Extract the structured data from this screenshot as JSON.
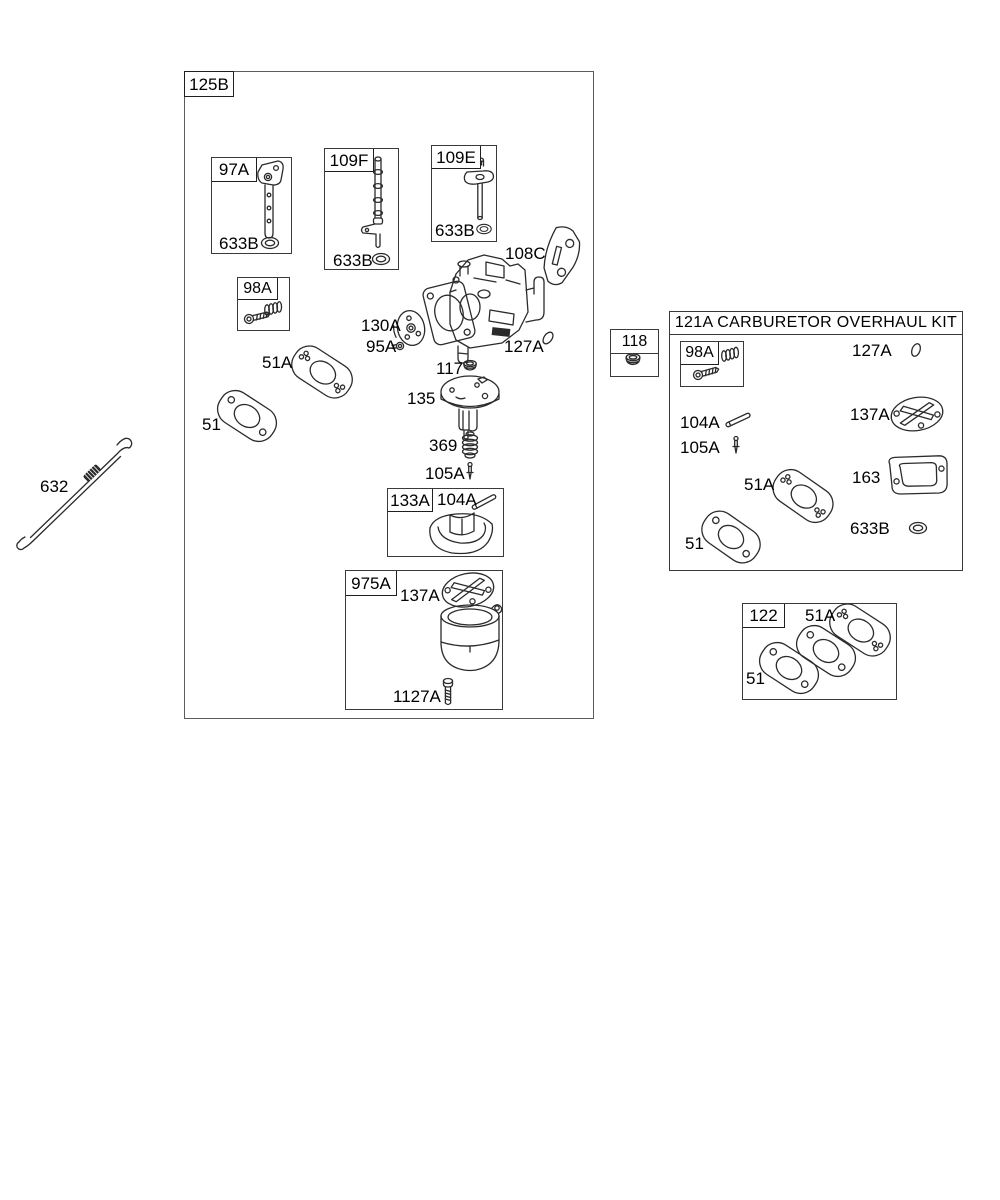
{
  "colors": {
    "line": "#2b2b2b",
    "background": "#ffffff",
    "box_border": "#5c5c5c"
  },
  "main_box": {
    "label": "125B"
  },
  "throttle_group": {
    "label": "97A",
    "seal": "633B"
  },
  "mixture_screw_group": {
    "label": "98A"
  },
  "needle_valve_group": {
    "label": "109F",
    "seal": "633B"
  },
  "choke_shaft_group": {
    "label": "109E",
    "seal": "633B"
  },
  "carb_callouts": {
    "plate": "108C",
    "disc": "130A",
    "screw": "95A",
    "oring": "127A",
    "plug": "117",
    "upper_body": "135",
    "spring": "369",
    "needle": "105A",
    "gasket_upper": "51A",
    "gasket_lower": "51"
  },
  "float_group": {
    "label": "133A",
    "pin": "104A"
  },
  "bowl_group": {
    "label": "975A",
    "gasket": "137A",
    "screw": "1127A"
  },
  "spring_link": {
    "label": "632"
  },
  "plug_group": {
    "label": "118"
  },
  "overhaul_kit": {
    "title": "121A CARBURETOR OVERHAUL KIT",
    "screw_box_label": "98A",
    "oring": "127A",
    "pin": "104A",
    "needle": "105A",
    "round_gasket": "137A",
    "flange_gasket_upper": "51A",
    "body_gasket": "163",
    "flange_gasket_lower": "51",
    "seal": "633B"
  },
  "gasket_kit": {
    "label": "122",
    "gasket_upper": "51A",
    "gasket_lower": "51"
  }
}
